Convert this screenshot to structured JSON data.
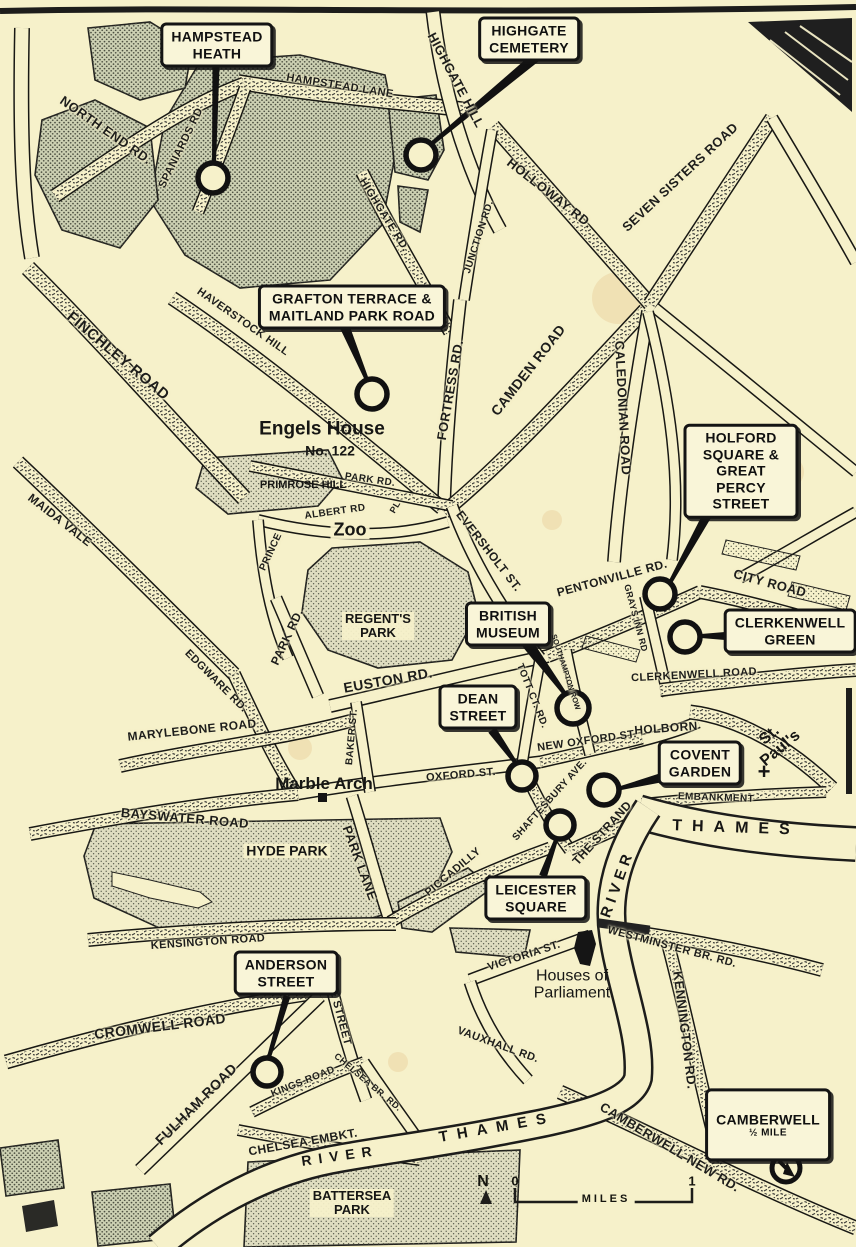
{
  "map": {
    "callouts": {
      "hampstead_heath": "HAMPSTEAD\nHEATH",
      "highgate_cemetery": "HIGHGATE\nCEMETERY",
      "grafton": "GRAFTON TERRACE &\nMAITLAND PARK ROAD",
      "holford": "HOLFORD SQUARE &\nGREAT PERCY STREET",
      "clerkenwell_green": "CLERKENWELL\nGREEN",
      "british_museum": "BRITISH\nMUSEUM",
      "dean_street": "DEAN\nSTREET",
      "covent_garden": "COVENT\nGARDEN",
      "leicester_square": "LEICESTER\nSQUARE",
      "anderson_street": "ANDERSON\nSTREET",
      "camberwell": {
        "title": "CAMBERWELL",
        "distance": "½ MILE"
      }
    },
    "places": {
      "engels_house": "Engels House",
      "engels_no": "No. 122",
      "zoo": "Zoo",
      "marble_arch": "Marble Arch",
      "houses_of_parliament": "Houses of\nParliament",
      "st_pauls": "St.\nPaul's",
      "st_pauls_cross": "+",
      "primrose_hill": "PRIMROSE HILL",
      "regents_park": "REGENT'S\nPARK",
      "hyde_park": "HYDE PARK",
      "battersea_park": "BATTERSEA\nPARK",
      "thames_upper": "THAMES",
      "thames_lower": "THAMES",
      "river_west": "RIVER",
      "river_lower": "RIVER"
    },
    "roads": {
      "north_end": "NORTH END RD.",
      "spaniards": "SPANIARDS RD",
      "hampstead_lane": "HAMPSTEAD LANE",
      "highgate_hill": "HIGHGATE HILL",
      "holloway": "HOLLOWAY RD.",
      "seven_sisters": "SEVEN SISTERS ROAD",
      "junction": "JUNCTION RD.",
      "highgate_rd": "HIGHGATE RD.",
      "finchley": "FINCHLEY ROAD",
      "haverstock": "HAVERSTOCK HILL",
      "fortress": "FORTRESS RD.",
      "camden": "CAMDEN ROAD",
      "caledonian": "CALEDONIAN ROAD",
      "maida_vale": "MAIDA VALE",
      "park_rd_north": "PARK RD.",
      "albert": "ALBERT RD",
      "pl": "PL",
      "prince": "PRINCE",
      "park_rd_west": "PARK RD.",
      "edgware": "EDGWARE RD.",
      "marylebone": "MARYLEBONE ROAD",
      "euston": "EUSTON RD.",
      "baker": "BAKER ST.",
      "eversholt": "EVERSHOLT ST.",
      "pentonville": "PENTONVILLE RD.",
      "city_road": "CITY ROAD",
      "grays_inn": "GRAYS INN RD",
      "clerkenwell_road": "CLERKENWELL ROAD",
      "holborn": "HOLBORN",
      "new_oxford": "NEW OXFORD ST.",
      "oxford": "OXFORD ST.",
      "tottenham_ct": "TOTT CT. RD.",
      "southampton_row": "SOUTHAMPTON ROW",
      "shaftesbury": "SHAFTESBURY AVE.",
      "strand": "THE STRAND",
      "embankment": "EMBANKMENT",
      "bayswater": "BAYSWATER ROAD",
      "park_lane": "PARK LANE",
      "piccadilly": "PICCADILLY",
      "kensington": "KENSINGTON ROAD",
      "victoria": "VICTORIA ST.",
      "westminster_br": "WESTMINSTER BR. RD.",
      "kennington": "KENNINGTON RD.",
      "cromwell": "CROMWELL ROAD",
      "sloane": "SLOANE STREET",
      "fulham": "FULHAM ROAD",
      "kings": "KINGS ROAD",
      "chelsea_br": "CHELSEA BR. RD.",
      "chelsea_embkt": "CHELSEA EMBKT.",
      "vauxhall": "VAUXHALL RD.",
      "camberwell_new": "CAMBERWELL NEW RD."
    },
    "scale": {
      "north": "N",
      "zero": "0",
      "one": "1",
      "miles": "MILES"
    },
    "colors": {
      "paper": "#f6f1ca",
      "ink": "#1d1d1b",
      "park": "#dfddc0",
      "heath": "#ccd0b2"
    }
  }
}
